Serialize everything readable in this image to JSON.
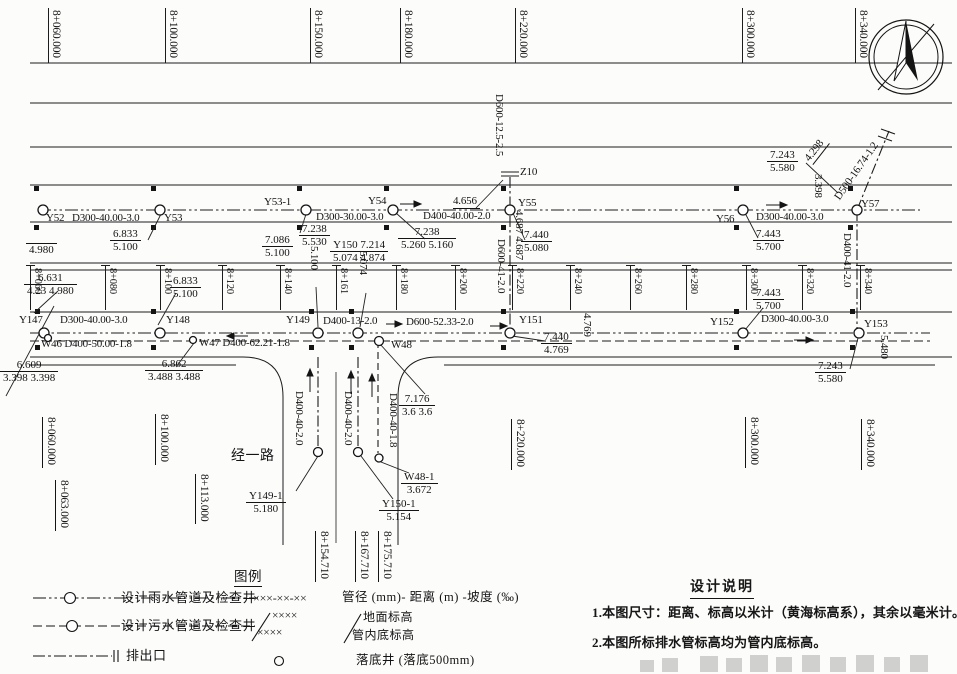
{
  "legend": {
    "title": "图例",
    "rain_label": "设计雨水管道及检查井",
    "rain_code": "×××-××-××",
    "rain_code_desc": "管径 (mm)- 距离 (m) -坡度 (‰)",
    "sewage_label": "设计污水管道及检查井",
    "sample_top": "××××",
    "sample_bottom": "××××",
    "ground_label": "地面标高",
    "invert_label": "管内底标高",
    "outlet_label": "排出口",
    "drop_well_label": "落底井 (落底500mm)"
  },
  "notes": {
    "title": "设计说明",
    "items": [
      "1.本图尺寸：距离、标高以米计（黄海标高系），其余以毫米计。",
      "2.本图所标排水管标高均为管内底标高。"
    ]
  },
  "road": {
    "name": "经一路"
  },
  "stations_top": [
    {
      "x": 48,
      "t": "8+060.000"
    },
    {
      "x": 165,
      "t": "8+100.000"
    },
    {
      "x": 310,
      "t": "8+150.000"
    },
    {
      "x": 400,
      "t": "8+180.000"
    },
    {
      "x": 515,
      "t": "8+220.000"
    },
    {
      "x": 742,
      "t": "8+300.000"
    },
    {
      "x": 855,
      "t": "8+340.000"
    }
  ],
  "stations_mid": [
    {
      "x": 30,
      "t": "8+060"
    },
    {
      "x": 105,
      "t": "8+080"
    },
    {
      "x": 160,
      "t": "8+100"
    },
    {
      "x": 222,
      "t": "8+120"
    },
    {
      "x": 280,
      "t": "8+140"
    },
    {
      "x": 336,
      "t": "8+161"
    },
    {
      "x": 396,
      "t": "8+180"
    },
    {
      "x": 455,
      "t": "8+200"
    },
    {
      "x": 512,
      "t": "8+220"
    },
    {
      "x": 570,
      "t": "8+240"
    },
    {
      "x": 630,
      "t": "8+260"
    },
    {
      "x": 686,
      "t": "8+280"
    },
    {
      "x": 746,
      "t": "8+300"
    },
    {
      "x": 802,
      "t": "8+320"
    },
    {
      "x": 860,
      "t": "8+340"
    }
  ],
  "stations_bottom": [
    {
      "x": 43,
      "y": 417,
      "t": "8+060.000"
    },
    {
      "x": 56,
      "y": 480,
      "t": "8+063.000"
    },
    {
      "x": 156,
      "y": 414,
      "t": "8+100.000"
    },
    {
      "x": 196,
      "y": 474,
      "t": "8+113.000"
    },
    {
      "x": 512,
      "y": 419,
      "t": "8+220.000"
    },
    {
      "x": 746,
      "y": 417,
      "t": "8+300.000"
    },
    {
      "x": 862,
      "y": 419,
      "t": "8+340.000"
    },
    {
      "x": 316,
      "y": 531,
      "t": "8+154.710"
    },
    {
      "x": 356,
      "y": 531,
      "t": "8+167.710"
    },
    {
      "x": 379,
      "y": 531,
      "t": "8+175.710"
    }
  ],
  "annotations": [
    {
      "n": "manhole-label-y52",
      "x": 46,
      "y": 213,
      "t": "Y52"
    },
    {
      "n": "pipe-label-y52-y53",
      "x": 72,
      "y": 213,
      "t": "D300-40.00-3.0"
    },
    {
      "n": "manhole-label-y53",
      "x": 164,
      "y": 213,
      "t": "Y53"
    },
    {
      "n": "manhole-label-y53-1",
      "x": 264,
      "y": 197,
      "t": "Y53-1"
    },
    {
      "n": "pipe-label-y531-y54",
      "x": 316,
      "y": 212,
      "t": "D300-30.00-3.0"
    },
    {
      "n": "manhole-label-y54",
      "x": 368,
      "y": 196,
      "t": "Y54"
    },
    {
      "n": "pipe-label-y54-y55",
      "x": 423,
      "y": 211,
      "t": "D400-40.00-2.0"
    },
    {
      "n": "distance-z10",
      "x": 453,
      "y": 196,
      "t": "4.656",
      "u": true
    },
    {
      "n": "manhole-label-y55",
      "x": 518,
      "y": 198,
      "t": "Y55"
    },
    {
      "n": "outfall-label-z10",
      "x": 520,
      "y": 167,
      "t": "Z10"
    },
    {
      "n": "manhole-label-y56",
      "x": 716,
      "y": 214,
      "t": "Y56"
    },
    {
      "n": "pipe-label-y56-y57",
      "x": 756,
      "y": 212,
      "t": "D300-40.00-3.0"
    },
    {
      "n": "manhole-label-y57",
      "x": 861,
      "y": 199,
      "t": "Y57"
    },
    {
      "n": "pipe-label-d500-outfall",
      "x": 833,
      "y": 196,
      "t": "D500-16.74-1.2",
      "r": -55
    },
    {
      "n": "distance-4298",
      "x": 803,
      "y": 157,
      "t": "4.298",
      "r": -52,
      "u": true
    },
    {
      "n": "elev-3398-vert",
      "x": 823,
      "y": 174,
      "t": "3.398",
      "r": 90
    },
    {
      "n": "pipe-label-d600-z10",
      "x": 504,
      "y": 94,
      "t": "D600-12.5-2.5",
      "r": 90
    },
    {
      "n": "pipe-label-d600-y55-y151",
      "x": 506,
      "y": 239,
      "t": "D600-41-2.0",
      "r": 90
    },
    {
      "n": "elev-4687-vert",
      "x": 524,
      "y": 210,
      "t": "4.687 4.687",
      "r": 90
    },
    {
      "n": "pipe-label-d400-y57-y153",
      "x": 852,
      "y": 233,
      "t": "D400-41-2.0",
      "r": 90
    },
    {
      "n": "manhole-label-y147",
      "x": 19,
      "y": 315,
      "t": "Y147"
    },
    {
      "n": "pipe-label-y147-y148",
      "x": 60,
      "y": 315,
      "t": "D300-40.00-3.0"
    },
    {
      "n": "manhole-label-y148",
      "x": 166,
      "y": 315,
      "t": "Y148"
    },
    {
      "n": "manhole-label-y149",
      "x": 286,
      "y": 315,
      "t": "Y149"
    },
    {
      "n": "pipe-label-y149-y150",
      "x": 323,
      "y": 316,
      "t": "D400-13-2.0"
    },
    {
      "n": "pipe-label-y150-y151",
      "x": 406,
      "y": 317,
      "t": "D600-52.33-2.0"
    },
    {
      "n": "manhole-label-y151",
      "x": 519,
      "y": 315,
      "t": "Y151"
    },
    {
      "n": "manhole-label-y152",
      "x": 710,
      "y": 317,
      "t": "Y152"
    },
    {
      "n": "pipe-label-y152-y153",
      "x": 761,
      "y": 314,
      "t": "D300-40.00-3.0"
    },
    {
      "n": "manhole-label-y153",
      "x": 864,
      "y": 319,
      "t": "Y153"
    },
    {
      "n": "pipe-label-w46",
      "x": 41,
      "y": 339,
      "t": "W46 D400-50.00-1.8"
    },
    {
      "n": "pipe-label-w47",
      "x": 199,
      "y": 338,
      "t": "W47 D400-62.21-1.8"
    },
    {
      "n": "manhole-label-w48",
      "x": 391,
      "y": 340,
      "t": "W48"
    },
    {
      "n": "elev-5100-vert",
      "x": 319,
      "y": 246,
      "t": "5.100",
      "r": 90
    },
    {
      "n": "elev-5074-vert",
      "x": 368,
      "y": 251,
      "t": "5.074",
      "r": 90
    },
    {
      "n": "elev-4769-vert",
      "x": 592,
      "y": 313,
      "t": "4.769",
      "r": 90
    },
    {
      "n": "elev-5480-vert",
      "x": 889,
      "y": 335,
      "t": "5.480",
      "r": 90
    },
    {
      "n": "road-name",
      "x": 231,
      "y": 450,
      "t": "经一路",
      "s": 14
    },
    {
      "n": "pipe-label-leg-1",
      "x": 304,
      "y": 391,
      "t": "D400-40-2.0",
      "r": 90
    },
    {
      "n": "pipe-label-leg-2",
      "x": 353,
      "y": 391,
      "t": "D400-40-2.0",
      "r": 90
    },
    {
      "n": "pipe-label-leg-3",
      "x": 398,
      "y": 393,
      "t": "D400-40-1.8",
      "r": 90
    }
  ],
  "elevation_fractions": [
    {
      "n": "elev-y52",
      "x": 26,
      "y": 241,
      "top": "",
      "bot": "4.980"
    },
    {
      "n": "elev-y53",
      "x": 110,
      "y": 228,
      "top": "6.833",
      "bot": "5.100"
    },
    {
      "n": "elev-y531-a",
      "x": 262,
      "y": 234,
      "top": "7.086",
      "bot": "5.100"
    },
    {
      "n": "elev-y531-b",
      "x": 299,
      "y": 223,
      "top": "7.238",
      "bot": "5.530"
    },
    {
      "n": "elev-y150",
      "x": 330,
      "y": 239,
      "top": "Y150 7.214",
      "bot": "5.074 4.874"
    },
    {
      "n": "elev-y54",
      "x": 398,
      "y": 226,
      "top": "7.238",
      "bot": "5.260 5.160"
    },
    {
      "n": "elev-y55",
      "x": 521,
      "y": 229,
      "top": "7.440",
      "bot": "5.080"
    },
    {
      "n": "elev-y56",
      "x": 753,
      "y": 228,
      "top": "7.443",
      "bot": "5.700"
    },
    {
      "n": "elev-y57",
      "x": 767,
      "y": 149,
      "top": "7.243",
      "bot": "5.580"
    },
    {
      "n": "elev-y151",
      "x": 541,
      "y": 331,
      "top": "7.440",
      "bot": "4.769"
    },
    {
      "n": "elev-y152",
      "x": 753,
      "y": 287,
      "top": "7.443",
      "bot": "5.700"
    },
    {
      "n": "elev-y153",
      "x": 815,
      "y": 360,
      "top": "7.243",
      "bot": "5.580"
    },
    {
      "n": "elev-w46",
      "x": 0,
      "y": 359,
      "top": "6.609",
      "bot": "3.398 3.398"
    },
    {
      "n": "elev-w47",
      "x": 145,
      "y": 358,
      "top": "6.862",
      "bot": "3.488 3.488"
    },
    {
      "n": "elev-w48",
      "x": 399,
      "y": 393,
      "top": "7.176",
      "bot": "3.6 3.6"
    },
    {
      "n": "elev-mid-a",
      "x": 24,
      "y": 272,
      "top": "6.631",
      "bot": "4.23 4.980"
    },
    {
      "n": "elev-mid-b",
      "x": 170,
      "y": 275,
      "top": "6.833",
      "bot": "5.100"
    },
    {
      "n": "well-y149-1",
      "x": 246,
      "y": 490,
      "top": "Y149-1",
      "bot": "5.180"
    },
    {
      "n": "well-y150-1",
      "x": 379,
      "y": 498,
      "top": "Y150-1",
      "bot": "5.154"
    },
    {
      "n": "well-w48-1",
      "x": 401,
      "y": 471,
      "top": "W48-1",
      "bot": "3.672"
    }
  ]
}
